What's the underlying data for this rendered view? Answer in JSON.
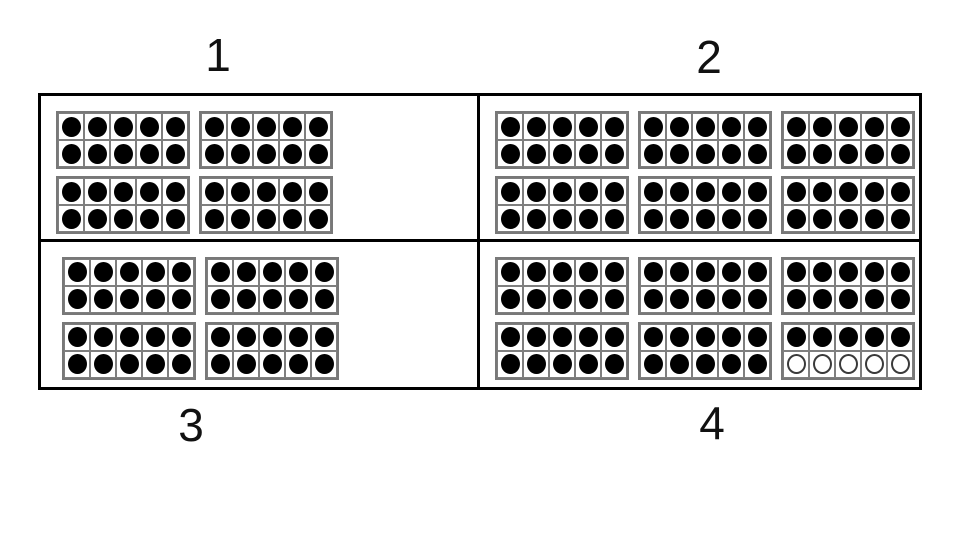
{
  "worksheet": {
    "kind": "ten-frame counting panels",
    "frame_rows": 2,
    "frame_columns": 5,
    "cells_per_frame": 10
  },
  "colors": {
    "background": "#ffffff",
    "panel_border": "#000000",
    "frame_border": "#787878",
    "cell_border": "#7f7f7f",
    "filled_dot": "#000000",
    "empty_dot_outline": "#3a3a3a"
  },
  "quadrants": [
    {
      "label": "1",
      "label_position": "top",
      "frames": [
        10,
        10,
        10,
        10,
        10,
        6
      ],
      "value_shown": 56
    },
    {
      "label": "2",
      "label_position": "top",
      "frames": [
        10,
        10,
        10,
        10,
        10,
        10
      ],
      "value_shown": 60
    },
    {
      "label": "3",
      "label_position": "bottom",
      "frames": [
        10,
        10,
        10,
        10,
        6
      ],
      "value_shown": 46
    },
    {
      "label": "4",
      "label_position": "bottom",
      "frames": [
        10,
        10,
        10,
        10,
        10,
        5
      ],
      "value_shown": 55
    }
  ]
}
